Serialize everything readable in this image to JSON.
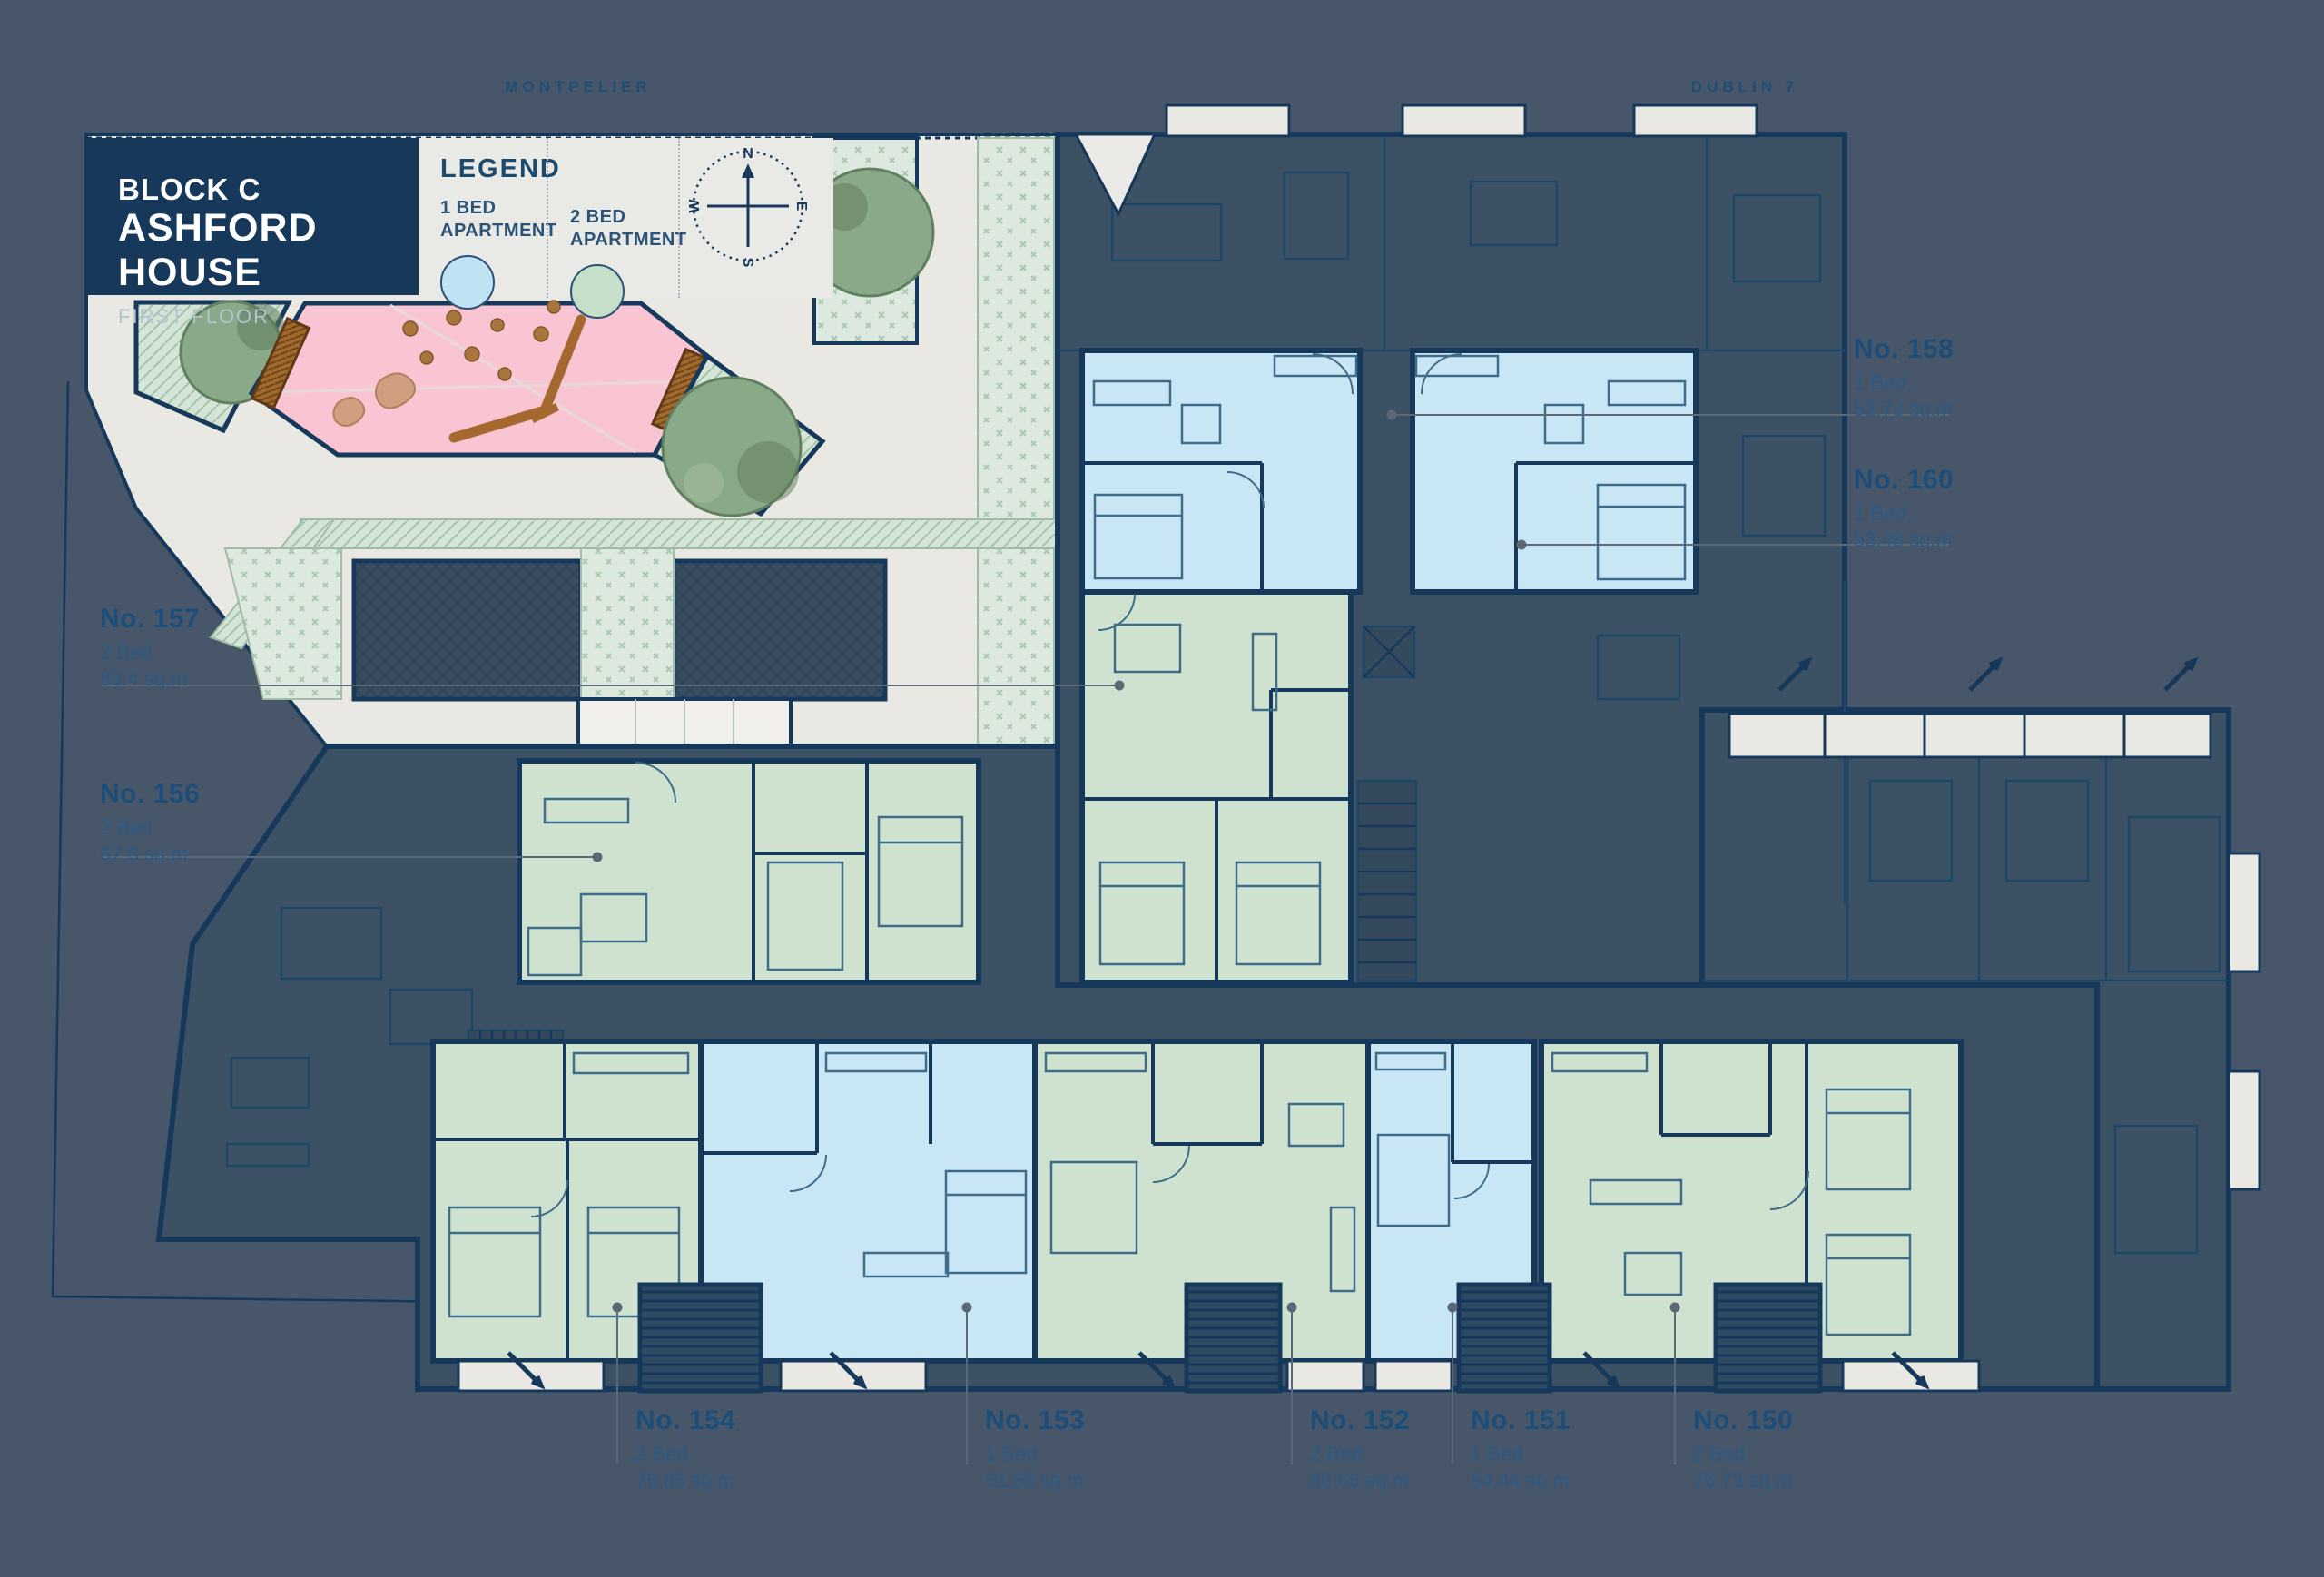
{
  "streets": {
    "top": "MONTPELIER",
    "right": "DUBLIN 7"
  },
  "title_block": {
    "block": "BLOCK C",
    "house": "ASHFORD HOUSE",
    "floor": "FIRST FLOOR"
  },
  "legend": {
    "title": "LEGEND",
    "items": [
      {
        "label": "1 BED\nAPARTMENT",
        "color": "#bfe3f2",
        "type": "1-bed"
      },
      {
        "label": "2 BED\nAPARTMENT",
        "color": "#c6dfc8",
        "type": "2-bed"
      }
    ]
  },
  "compass": {
    "n": "N",
    "e": "E",
    "s": "S",
    "w": "W"
  },
  "apartments": [
    {
      "number": "No. 158",
      "beds": "1 Bed",
      "area": "52.73 sq.m",
      "type": "1-bed"
    },
    {
      "number": "No. 160",
      "beds": "1 Bed",
      "area": "53.48 sq.m",
      "type": "1-bed"
    },
    {
      "number": "No. 157",
      "beds": "2 Bed",
      "area": "83.4 sq.m",
      "type": "2-bed"
    },
    {
      "number": "No. 156",
      "beds": "2 Bed",
      "area": "67.8 sq.m",
      "type": "2-bed"
    },
    {
      "number": "No. 154",
      "beds": "2 Bed",
      "area": "76.85 sq.m",
      "type": "2-bed"
    },
    {
      "number": "No. 153",
      "beds": "1 Bed",
      "area": "51.55 sq.m",
      "type": "1-bed"
    },
    {
      "number": "No. 152",
      "beds": "2 Bed",
      "area": "80.66 sq.m",
      "type": "2-bed"
    },
    {
      "number": "No. 151",
      "beds": "1 Bed",
      "area": "54.44 sq.m",
      "type": "1-bed"
    },
    {
      "number": "No. 150",
      "beds": "2 Bed",
      "area": "76.73 sq.m",
      "type": "2-bed"
    }
  ],
  "colors": {
    "background": "#475769",
    "navy": "#16395b",
    "building_dark": "#3d5165",
    "one_bed": "#c9e6f4",
    "two_bed": "#cfe2d0",
    "courtyard": "#e9e8e3",
    "play_area_pink": "#f9c5d3",
    "leader_gray": "#5b6875"
  }
}
